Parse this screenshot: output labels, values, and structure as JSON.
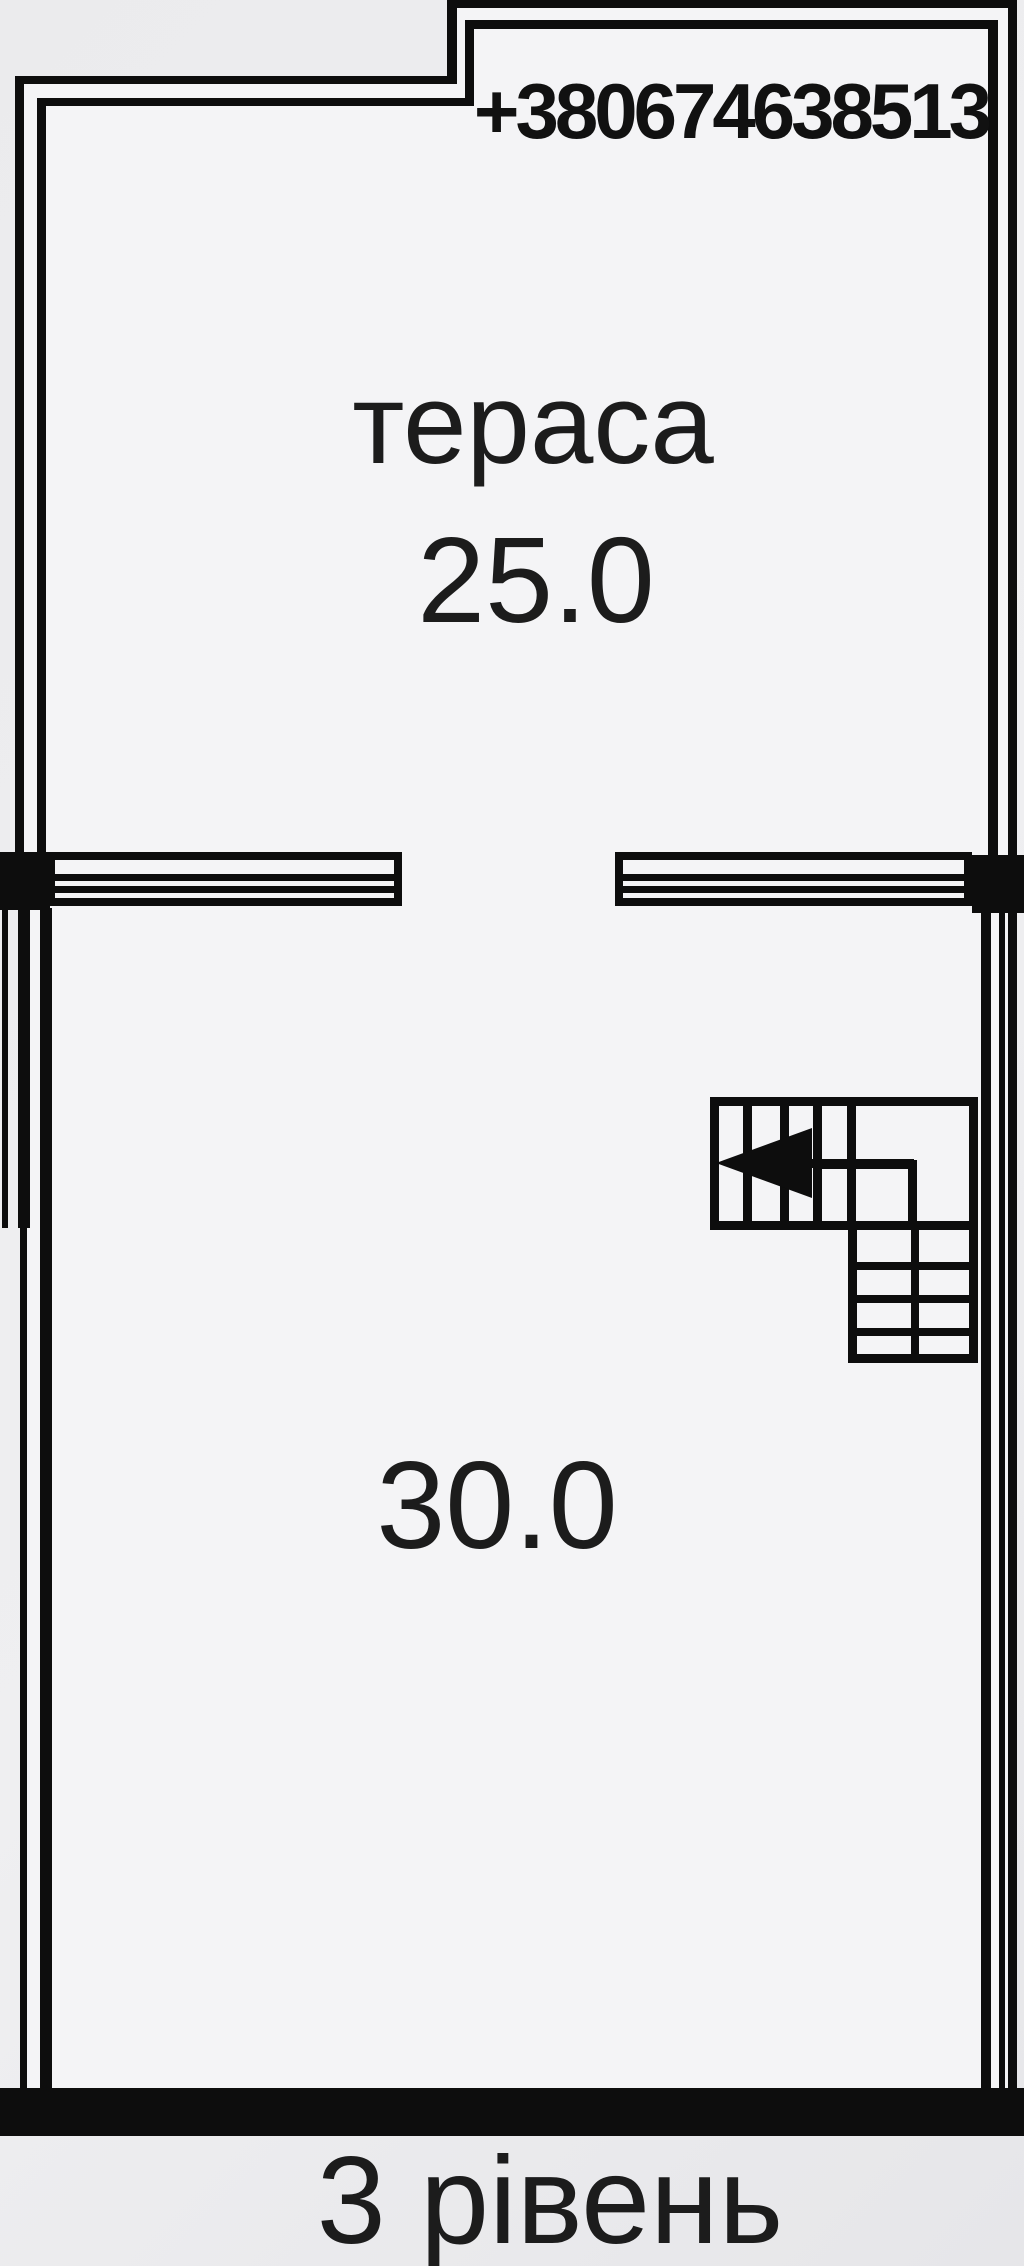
{
  "header": {
    "phone_number": "+380674638513"
  },
  "rooms": {
    "terrace": {
      "name": "тераса",
      "area": "25.0"
    },
    "main_room": {
      "area": "30.0"
    }
  },
  "stairs": {
    "description": "L-shaped staircase with left-pointing direction arrow"
  },
  "footer": {
    "level_label": "3 рівень"
  },
  "colors": {
    "wall": "#0d0d0d",
    "background": "#e9e9eb",
    "floor": "#f4f4f6",
    "text": "#1c1c1c"
  }
}
